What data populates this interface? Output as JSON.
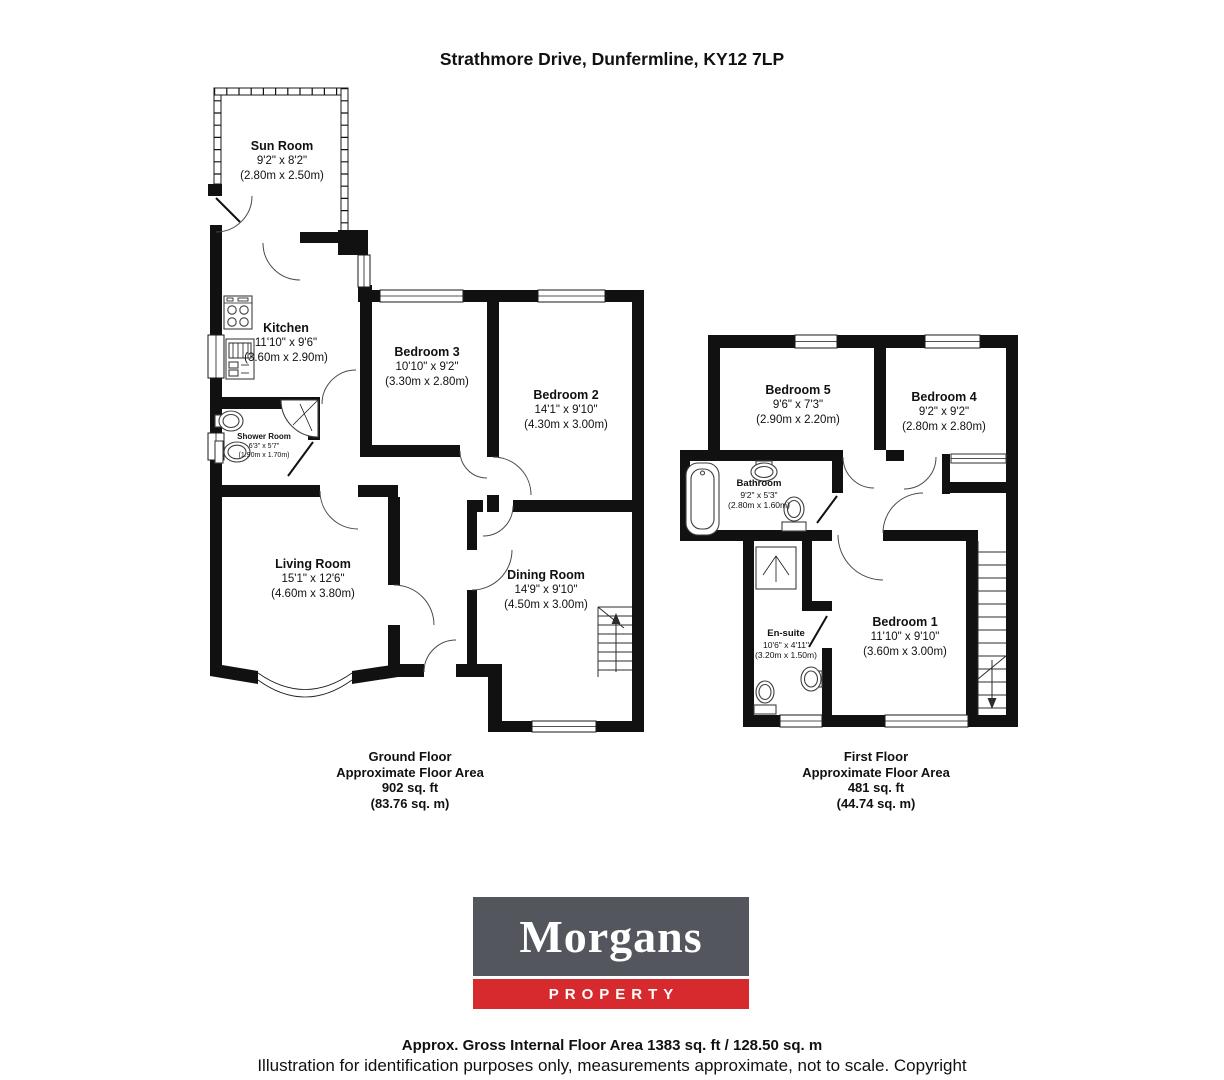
{
  "title": "Strathmore Drive, Dunfermline, KY12 7LP",
  "ground_floor": {
    "caption": {
      "line1": "Ground Floor",
      "line2": "Approximate Floor Area",
      "line3": "902 sq. ft",
      "line4": "(83.76 sq. m)"
    },
    "rooms": {
      "sun_room": {
        "name": "Sun Room",
        "imperial": "9'2\" x 8'2\"",
        "metric": "(2.80m x 2.50m)"
      },
      "kitchen": {
        "name": "Kitchen",
        "imperial": "11'10\" x 9'6\"",
        "metric": "(3.60m x 2.90m)"
      },
      "bedroom3": {
        "name": "Bedroom 3",
        "imperial": "10'10\" x 9'2\"",
        "metric": "(3.30m x 2.80m)"
      },
      "bedroom2": {
        "name": "Bedroom 2",
        "imperial": "14'1\" x 9'10\"",
        "metric": "(4.30m x 3.00m)"
      },
      "shower_room": {
        "name": "Shower Room",
        "imperial": "6'3\" x 5'7\"",
        "metric": "(1.90m x 1.70m)"
      },
      "living_room": {
        "name": "Living Room",
        "imperial": "15'1\" x 12'6\"",
        "metric": "(4.60m x 3.80m)"
      },
      "dining_room": {
        "name": "Dining Room",
        "imperial": "14'9\" x 9'10\"",
        "metric": "(4.50m x 3.00m)"
      }
    }
  },
  "first_floor": {
    "caption": {
      "line1": "First Floor",
      "line2": "Approximate Floor Area",
      "line3": "481 sq. ft",
      "line4": "(44.74 sq. m)"
    },
    "rooms": {
      "bedroom5": {
        "name": "Bedroom 5",
        "imperial": "9'6\" x 7'3\"",
        "metric": "(2.90m x 2.20m)"
      },
      "bedroom4": {
        "name": "Bedroom 4",
        "imperial": "9'2\" x 9'2\"",
        "metric": "(2.80m x 2.80m)"
      },
      "bathroom": {
        "name": "Bathroom",
        "imperial": "9'2\" x 5'3\"",
        "metric": "(2.80m x 1.60m)"
      },
      "en_suite": {
        "name": "En-suite",
        "imperial": "10'6\" x 4'11\"",
        "metric": "(3.20m x 1.50m)"
      },
      "bedroom1": {
        "name": "Bedroom 1",
        "imperial": "11'10\" x 9'10\"",
        "metric": "(3.60m x 3.00m)"
      }
    }
  },
  "logo": {
    "brand": "Morgans",
    "tagline": "PROPERTY",
    "grey": "#54565e",
    "red": "#d62a2e"
  },
  "footer": {
    "area": "Approx. Gross Internal Floor Area 1383 sq. ft / 128.50 sq. m",
    "disclaimer": "Illustration for identification purposes only, measurements approximate, not to scale. Copyright"
  }
}
